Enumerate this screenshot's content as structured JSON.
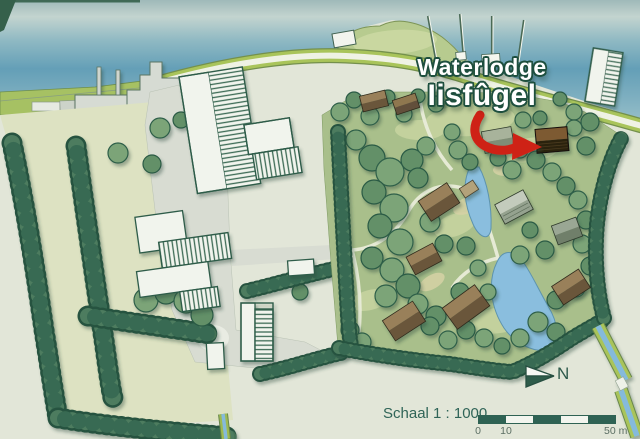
{
  "map_title": {
    "line1": "Waterlodge",
    "line2": "Iisfûgel"
  },
  "compass": {
    "north_label": "N"
  },
  "scale_bar": {
    "label": "Schaal 1 : 1000",
    "tick_start": "0",
    "tick_second": "10",
    "tick_end": "50 m",
    "segments": 5
  },
  "palette": {
    "water": "#69a3ba",
    "land_pale": "#e2e6d8",
    "field": "#dde2c2",
    "park_green": "#a9bf8b",
    "hedge_green": "#40725a",
    "road_verge": "#a9c45a",
    "paving_gray": "#d8dcd2",
    "lodge_roof_brown": "#99805a",
    "highlight_arrow_red": "#ce2418",
    "title_fill": "#ffffff",
    "title_outline": "#1e4f3e",
    "scale_text": "#2f6457"
  }
}
